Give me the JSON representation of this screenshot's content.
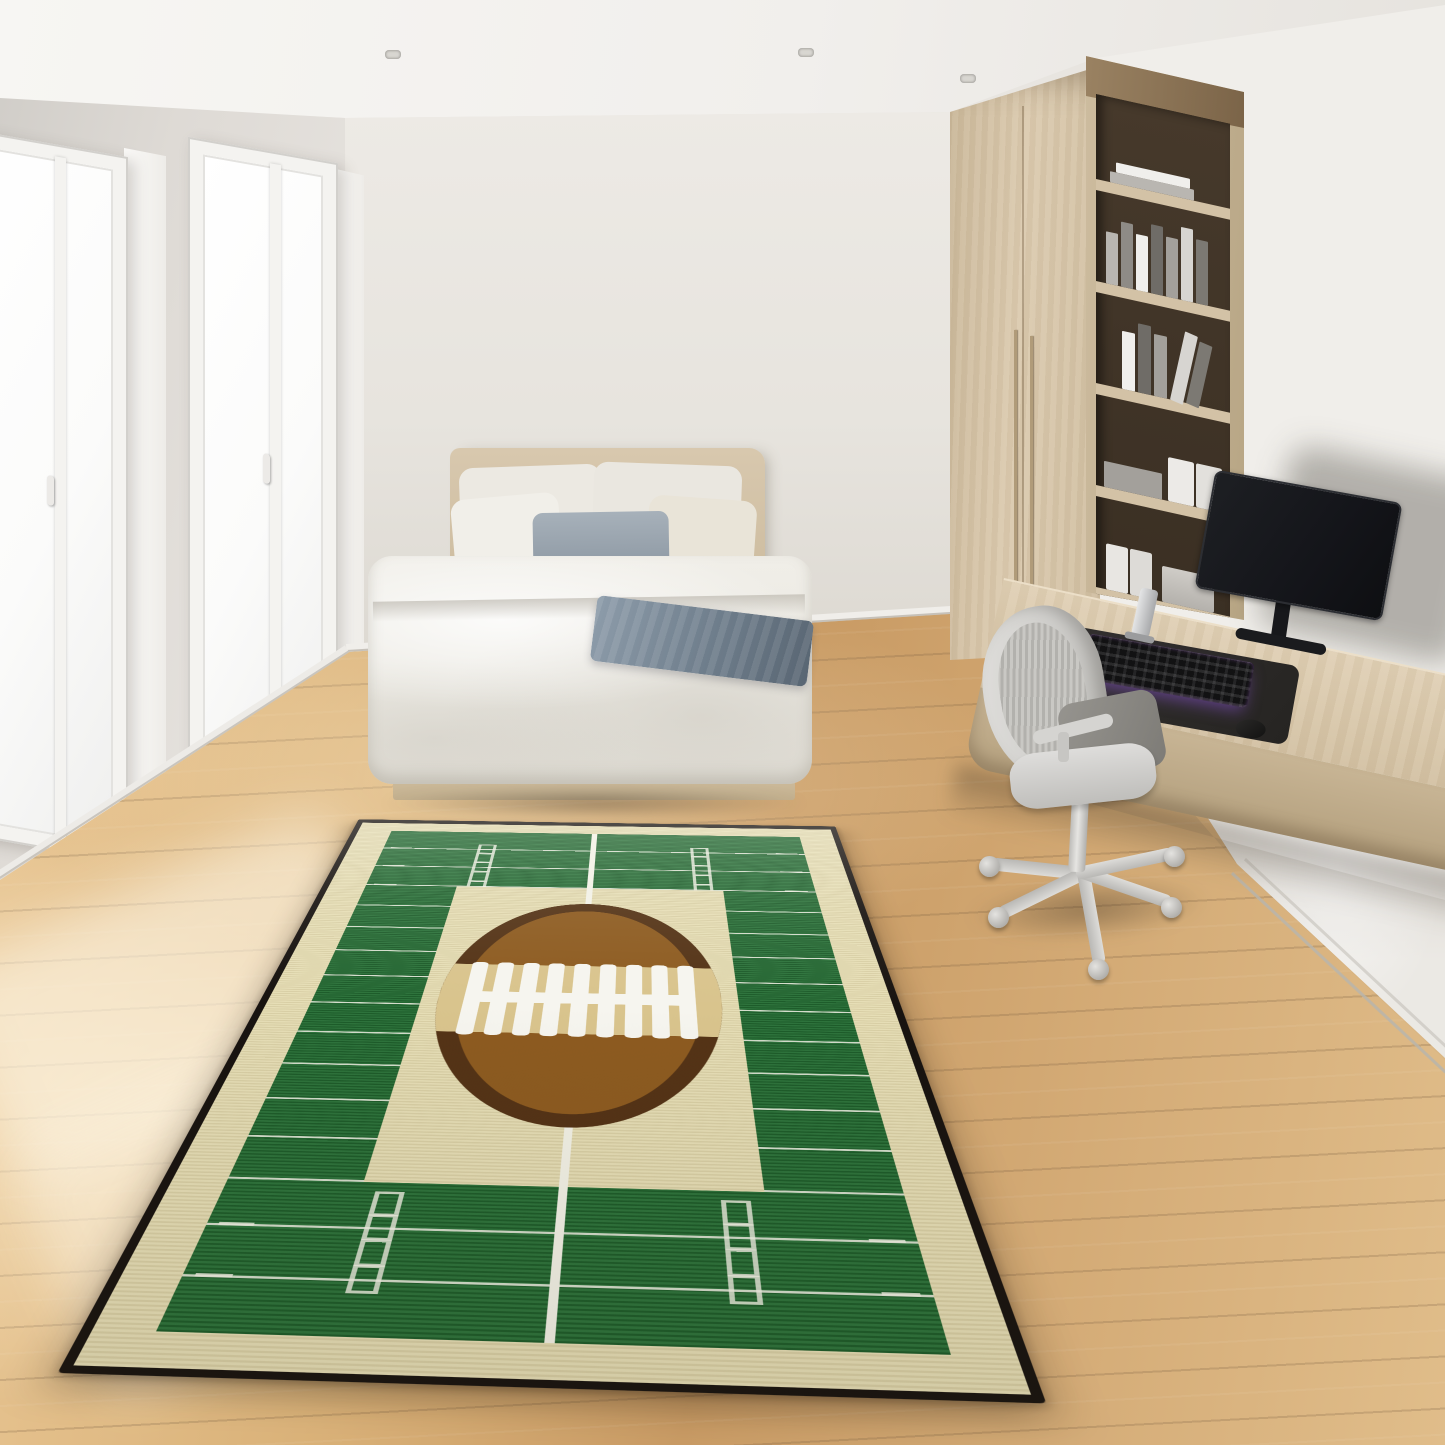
{
  "scene": {
    "type": "photorealistic interior render",
    "subject": "Football field area rug in a modern bedroom",
    "objects": [
      "ceiling-spotlights",
      "window-left",
      "window-right",
      "bed",
      "pillows",
      "throw-blanket",
      "wardrobe",
      "bookshelf",
      "floating-desk",
      "curved-monitor",
      "rgb-keyboard",
      "mouse",
      "desk-speaker",
      "office-chair",
      "wood-floor",
      "football-field-rug"
    ]
  },
  "colors": {
    "spot-ring": "#d8d6d1",
    "spot-core": "#a8a6a1",
    "window-frame": "#f4f3f0",
    "rug-trim": "#181310",
    "rug-cream": "#e5dcb2",
    "rug-green": "#226b31",
    "rug-line": "#f2f1e6",
    "ball-dark": "#543316",
    "ball-mid": "#8d5b20",
    "ball-band": "#d9c48d",
    "ball-laces": "#f6f5ef"
  },
  "rug": {
    "field_width": 830,
    "field_height": 1840,
    "yardline_spacing": 115,
    "yardline_count": 15,
    "square": {
      "x1": 169,
      "x2": 661,
      "y1": 350,
      "y2": 1500
    },
    "hash_columns": [
      205,
      625
    ],
    "tick_columns": [
      14,
      774
    ],
    "center_x": 410,
    "centerline_segments": [
      [
        0,
        445
      ],
      [
        1330,
        510
      ]
    ],
    "ball": {
      "left": 195,
      "top": 437,
      "width": 440,
      "height": 900
    },
    "lace_ticks": 9
  },
  "bookshelf": {
    "shelves": [
      {
        "kind": "flat-stack",
        "items": 2
      },
      {
        "kind": "upright-books",
        "items": 7
      },
      {
        "kind": "leaning-books",
        "items": 5
      },
      {
        "kind": "files-and-stack",
        "items": 3
      },
      {
        "kind": "files-and-box",
        "items": 3
      }
    ],
    "book_palette": [
      "#b9b6b1",
      "#8e8b86",
      "#f0efec",
      "#6f6c67",
      "#a3a09b",
      "#d7d5d1",
      "#7c7973"
    ]
  },
  "chair": {
    "leg_angles_deg": [
      186,
      154,
      80,
      19,
      -12
    ],
    "leg_length": 100
  },
  "ceiling_spots": [
    [
      385,
      50
    ],
    [
      798,
      48
    ],
    [
      960,
      74
    ],
    [
      1338,
      128
    ]
  ],
  "windows": [
    {
      "left": -44,
      "top": 142,
      "width": 172,
      "height": 706,
      "mullion_pct": 58,
      "handle_top_pct": 47
    },
    {
      "left": 188,
      "top": 150,
      "width": 150,
      "height": 658,
      "mullion_pct": 55,
      "handle_top_pct": 46
    }
  ]
}
